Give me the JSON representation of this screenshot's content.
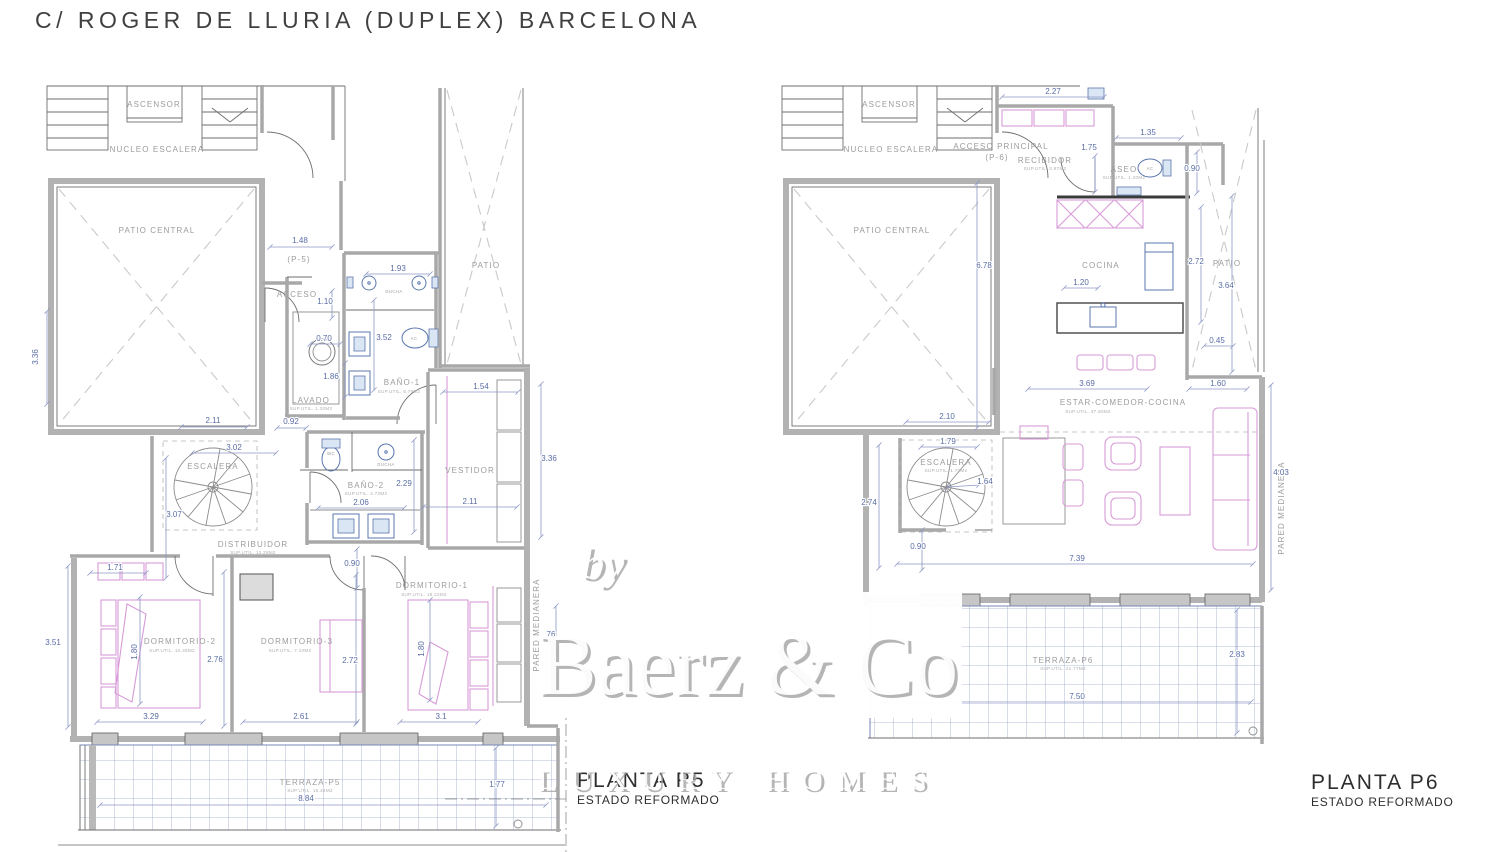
{
  "title": "C/ ROGER DE LLURIA  (DUPLEX) BARCELONA",
  "watermark": {
    "prefix": "by",
    "brand": "Baerz & Co",
    "tagline": "LUXURY HOMES"
  },
  "plans": {
    "p5": {
      "title": "PLANTA P5",
      "subtitle": "ESTADO REFORMADO",
      "rooms": [
        {
          "label": "ASCENSOR",
          "x": 154,
          "y": 107
        },
        {
          "label": "NUCLEO ESCALERA",
          "x": 157,
          "y": 152
        },
        {
          "label": "PATIO CENTRAL",
          "x": 157,
          "y": 233
        },
        {
          "label": "(P-5)",
          "x": 299,
          "y": 262,
          "size": 7
        },
        {
          "label": "ACCESO",
          "x": 297,
          "y": 297,
          "size": 7
        },
        {
          "label": "PATIO",
          "x": 486,
          "y": 268
        },
        {
          "label": "BAÑO-1",
          "x": 402,
          "y": 385,
          "sub": "SUP.UTIL. 6.79M2",
          "subx": 399,
          "suby": 393
        },
        {
          "label": "LAVADO",
          "x": 311,
          "y": 403,
          "sub": "SUP.UTIL. 1.30M2",
          "suby": 410
        },
        {
          "label": "ESCALERA",
          "x": 213,
          "y": 469,
          "size": 6.5
        },
        {
          "label": "BAÑO-2",
          "x": 366,
          "y": 488,
          "sub": "SUP.UTIL. 4.72M2",
          "suby": 495
        },
        {
          "label": "DISTRIBUIDOR",
          "x": 253,
          "y": 547,
          "sub": "SUP.UTIL. 12.28M2",
          "suby": 554
        },
        {
          "label": "VESTIDOR",
          "x": 470,
          "y": 473,
          "size": 5
        },
        {
          "label": "DORMITORIO-1",
          "x": 432,
          "y": 588,
          "sub": "SUP.UTIL. 18.22M2",
          "subx": 424,
          "suby": 596
        },
        {
          "label": "DORMITORIO-2",
          "x": 180,
          "y": 644,
          "sub": "SUP.UTIL. 10.35M2",
          "subx": 172,
          "suby": 652
        },
        {
          "label": "DORMITORIO-3",
          "x": 297,
          "y": 644,
          "sub": "SUP.UTIL. 7.10M2",
          "subx": 290,
          "suby": 652
        },
        {
          "label": "TERRAZA-P5",
          "x": 310,
          "y": 785,
          "sub": "SUP.UTIL. 16.44M2",
          "suby": 792
        },
        {
          "label": "PARED MEDIANERA",
          "x": 539,
          "y": 625,
          "rot": -90,
          "size": 5
        }
      ],
      "fixtures": [
        {
          "t": "DUCHA",
          "x": 394,
          "y": 293
        },
        {
          "t": "AC",
          "x": 414,
          "y": 340
        },
        {
          "t": "WC",
          "x": 331,
          "y": 455
        },
        {
          "t": "DUCHA",
          "x": 386,
          "y": 466
        }
      ],
      "dims": [
        {
          "t": "1.48",
          "x": 300,
          "y": 243,
          "line": [
            270,
            247,
            332,
            247
          ]
        },
        {
          "t": "1.93",
          "x": 398,
          "y": 271,
          "line": [
            366,
            274,
            430,
            274
          ]
        },
        {
          "t": "1.10",
          "x": 325,
          "y": 304,
          "line": [
            332,
            291,
            332,
            318
          ]
        },
        {
          "t": "0.70",
          "x": 324,
          "y": 341,
          "line": [
            310,
            344,
            340,
            344
          ]
        },
        {
          "t": "3.52",
          "x": 384,
          "y": 340,
          "line": [
            374,
            300,
            374,
            390
          ]
        },
        {
          "t": "1.86",
          "x": 331,
          "y": 379,
          "line": [
            345,
            363,
            345,
            397
          ]
        },
        {
          "t": "0.92",
          "x": 291,
          "y": 424,
          "line": [
            277,
            428,
            306,
            428
          ]
        },
        {
          "t": "2.11",
          "x": 213,
          "y": 423,
          "line": [
            181,
            427,
            247,
            427
          ]
        },
        {
          "t": "3.02",
          "x": 234,
          "y": 450,
          "line": [
            192,
            453,
            276,
            453
          ]
        },
        {
          "t": "3.07",
          "x": 174,
          "y": 517,
          "line": [
            166,
            458,
            166,
            578
          ]
        },
        {
          "t": "1.54",
          "x": 481,
          "y": 389,
          "line": [
            443,
            392,
            518,
            392
          ]
        },
        {
          "t": "3.36",
          "x": 549,
          "y": 461,
          "line": [
            541,
            384,
            541,
            537
          ]
        },
        {
          "t": "3.36",
          "x": 38,
          "y": 357,
          "rot": -90,
          "line": [
            47,
            311,
            47,
            404
          ]
        },
        {
          "t": "2.29",
          "x": 404,
          "y": 486,
          "line": [
            414,
            440,
            414,
            532
          ]
        },
        {
          "t": "2.06",
          "x": 361,
          "y": 505,
          "line": [
            318,
            508,
            404,
            508
          ]
        },
        {
          "t": "0.90",
          "x": 352,
          "y": 566,
          "line": [
            357,
            549,
            357,
            588
          ]
        },
        {
          "t": "2.11",
          "x": 470,
          "y": 504,
          "line": [
            423,
            507,
            517,
            507
          ]
        },
        {
          "t": "1.71",
          "x": 115,
          "y": 570,
          "line": [
            90,
            573,
            146,
            573
          ]
        },
        {
          "t": "3.51",
          "x": 53,
          "y": 645,
          "line": [
            68,
            566,
            68,
            727
          ]
        },
        {
          "t": "1.80",
          "x": 137,
          "y": 652,
          "rot": -90,
          "size": 5.5,
          "line": [
            140,
            597,
            140,
            704
          ]
        },
        {
          "t": "2.76",
          "x": 215,
          "y": 662,
          "line": [
            224,
            572,
            224,
            726
          ]
        },
        {
          "t": "3.29",
          "x": 151,
          "y": 719,
          "line": [
            97,
            722,
            203,
            722
          ]
        },
        {
          "t": "2.61",
          "x": 301,
          "y": 719,
          "line": [
            243,
            722,
            357,
            722
          ]
        },
        {
          "t": "2.72",
          "x": 350,
          "y": 663,
          "line": [
            356,
            575,
            356,
            724
          ]
        },
        {
          "t": "3.1",
          "x": 441,
          "y": 719,
          "line": [
            400,
            722,
            478,
            722
          ]
        },
        {
          "t": "1.80",
          "x": 424,
          "y": 649,
          "rot": -90,
          "size": 5.5,
          "line": [
            430,
            600,
            430,
            700
          ]
        },
        {
          "t": "8.84",
          "x": 306,
          "y": 801,
          "line": [
            100,
            805,
            546,
            805
          ]
        },
        {
          "t": "1.77",
          "x": 497,
          "y": 787,
          "line": [
            496,
            748,
            496,
            826
          ]
        }
      ]
    },
    "p6": {
      "title": "PLANTA P6",
      "subtitle": "ESTADO REFORMADO",
      "rooms": [
        {
          "label": "ASCENSOR",
          "x": 889,
          "y": 107
        },
        {
          "label": "NUCLEO ESCALERA",
          "x": 891,
          "y": 152
        },
        {
          "label": "ACCESO PRINCIPAL",
          "x": 1001,
          "y": 149,
          "size": 7
        },
        {
          "label": "(P-6)",
          "x": 997,
          "y": 160,
          "size": 7
        },
        {
          "label": "RECIBIDOR",
          "x": 1045,
          "y": 163,
          "size": 7,
          "sub": "SUP.UTIL. 3.97M2",
          "suby": 170
        },
        {
          "label": "ASEO",
          "x": 1124,
          "y": 172,
          "size": 7,
          "sub": "SUP.UTIL. 1.20M2",
          "suby": 179
        },
        {
          "label": "PATIO CENTRAL",
          "x": 892,
          "y": 233
        },
        {
          "label": "COCINA",
          "x": 1101,
          "y": 268
        },
        {
          "label": "PATIO",
          "x": 1227,
          "y": 266
        },
        {
          "label": "ESTAR-COMEDOR-COCINA",
          "x": 1123,
          "y": 405,
          "sub": "SUP.UTIL. 37.80M2",
          "subx": 1088,
          "suby": 413
        },
        {
          "label": "ESCALERA",
          "x": 946,
          "y": 465,
          "size": 6,
          "sub": "SUP.UTIL. 1.70M2",
          "suby": 472
        },
        {
          "label": "TERRAZA-P6",
          "x": 1063,
          "y": 663,
          "sub": "SUP.UTIL. 21.77M2",
          "suby": 670
        },
        {
          "label": "PARED MEDIANERA",
          "x": 1284,
          "y": 508,
          "rot": -90,
          "size": 5
        }
      ],
      "fixtures": [
        {
          "t": "AC",
          "x": 1150,
          "y": 170
        }
      ],
      "dims": [
        {
          "t": "2.27",
          "x": 1053,
          "y": 94,
          "line": [
            1002,
            97,
            1104,
            97
          ]
        },
        {
          "t": "1.35",
          "x": 1148,
          "y": 135,
          "line": [
            1116,
            138,
            1181,
            138
          ]
        },
        {
          "t": "1.75",
          "x": 1089,
          "y": 150,
          "line": [
            1095,
            156,
            1095,
            192
          ]
        },
        {
          "t": "0.90",
          "x": 1192,
          "y": 171,
          "line": [
            1197,
            152,
            1197,
            193
          ]
        },
        {
          "t": "6.78",
          "x": 984,
          "y": 268,
          "line": [
            977,
            183,
            977,
            428
          ]
        },
        {
          "t": "2.72",
          "x": 1196,
          "y": 264,
          "line": [
            1201,
            207,
            1201,
            322
          ]
        },
        {
          "t": "3.64",
          "x": 1226,
          "y": 288,
          "line": [
            1232,
            196,
            1232,
            372
          ]
        },
        {
          "t": "1.20",
          "x": 1081,
          "y": 285,
          "line": [
            1064,
            288,
            1098,
            288
          ]
        },
        {
          "t": "0.45",
          "x": 1217,
          "y": 343,
          "line": [
            1204,
            346,
            1233,
            346
          ]
        },
        {
          "t": "3.69",
          "x": 1087,
          "y": 386,
          "line": [
            1028,
            389,
            1147,
            389
          ]
        },
        {
          "t": "1.60",
          "x": 1218,
          "y": 386,
          "line": [
            1189,
            389,
            1247,
            389
          ]
        },
        {
          "t": "2.10",
          "x": 947,
          "y": 419,
          "line": [
            906,
            422,
            989,
            422
          ]
        },
        {
          "t": "1.79",
          "x": 948,
          "y": 444,
          "line": [
            921,
            447,
            977,
            447
          ]
        },
        {
          "t": "1.64",
          "x": 985,
          "y": 484,
          "line": [
            948,
            487,
            979,
            485
          ]
        },
        {
          "t": "2.74",
          "x": 869,
          "y": 505,
          "line": [
            879,
            445,
            879,
            568
          ]
        },
        {
          "t": "0.90",
          "x": 918,
          "y": 549,
          "line": [
            922,
            530,
            922,
            570
          ]
        },
        {
          "t": "7.39",
          "x": 1077,
          "y": 561,
          "line": [
            897,
            564,
            1253,
            564
          ]
        },
        {
          "t": "4.03",
          "x": 1281,
          "y": 475,
          "line": [
            1271,
            385,
            1271,
            590
          ]
        },
        {
          "t": "2.83",
          "x": 1237,
          "y": 657,
          "line": [
            1237,
            610,
            1237,
            733
          ]
        },
        {
          "t": "7.50",
          "x": 1077,
          "y": 699,
          "line": [
            886,
            702,
            1251,
            702
          ]
        }
      ]
    }
  },
  "overlay_dims": [
    {
      "t": "76",
      "x": 551,
      "y": 637,
      "line": [
        556,
        606,
        556,
        664
      ]
    }
  ]
}
